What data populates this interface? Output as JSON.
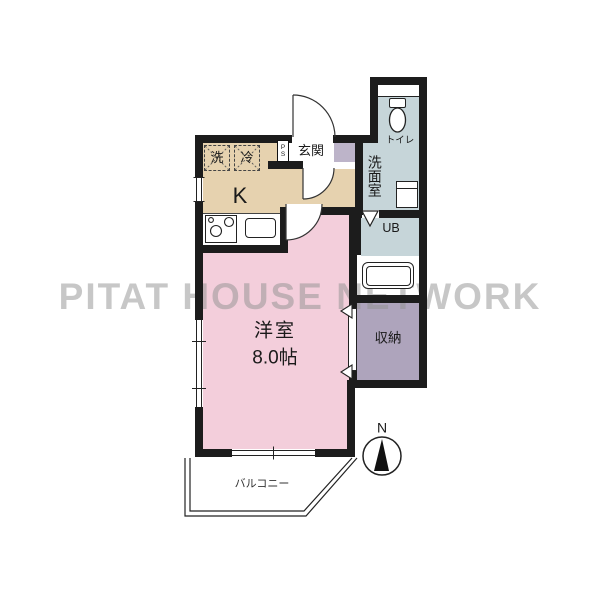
{
  "watermark": "PITAT HOUSE NETWORK",
  "rooms": {
    "kitchen": {
      "label": "K"
    },
    "western_room": {
      "label": "洋室",
      "size": "8.0帖"
    },
    "entrance": {
      "label": "玄関"
    },
    "pipe_space": {
      "label": "PS"
    },
    "toilet": {
      "label": "トイレ"
    },
    "washroom": {
      "label": "洗面室"
    },
    "unit_bath": {
      "label": "UB"
    },
    "storage": {
      "label": "収納"
    },
    "balcony": {
      "label": "バルコニー"
    }
  },
  "fixtures": {
    "washer_label": "洗",
    "fridge_label": "冷"
  },
  "compass": {
    "label": "N"
  },
  "colors": {
    "wall": "#1c1c1c",
    "kitchen": "#e6d2af",
    "room": "#f3cedb",
    "wet": "#c6d5d9",
    "storage": "#aea4bc",
    "cabinet": "#bdb4c9",
    "watermark": "#919191"
  }
}
